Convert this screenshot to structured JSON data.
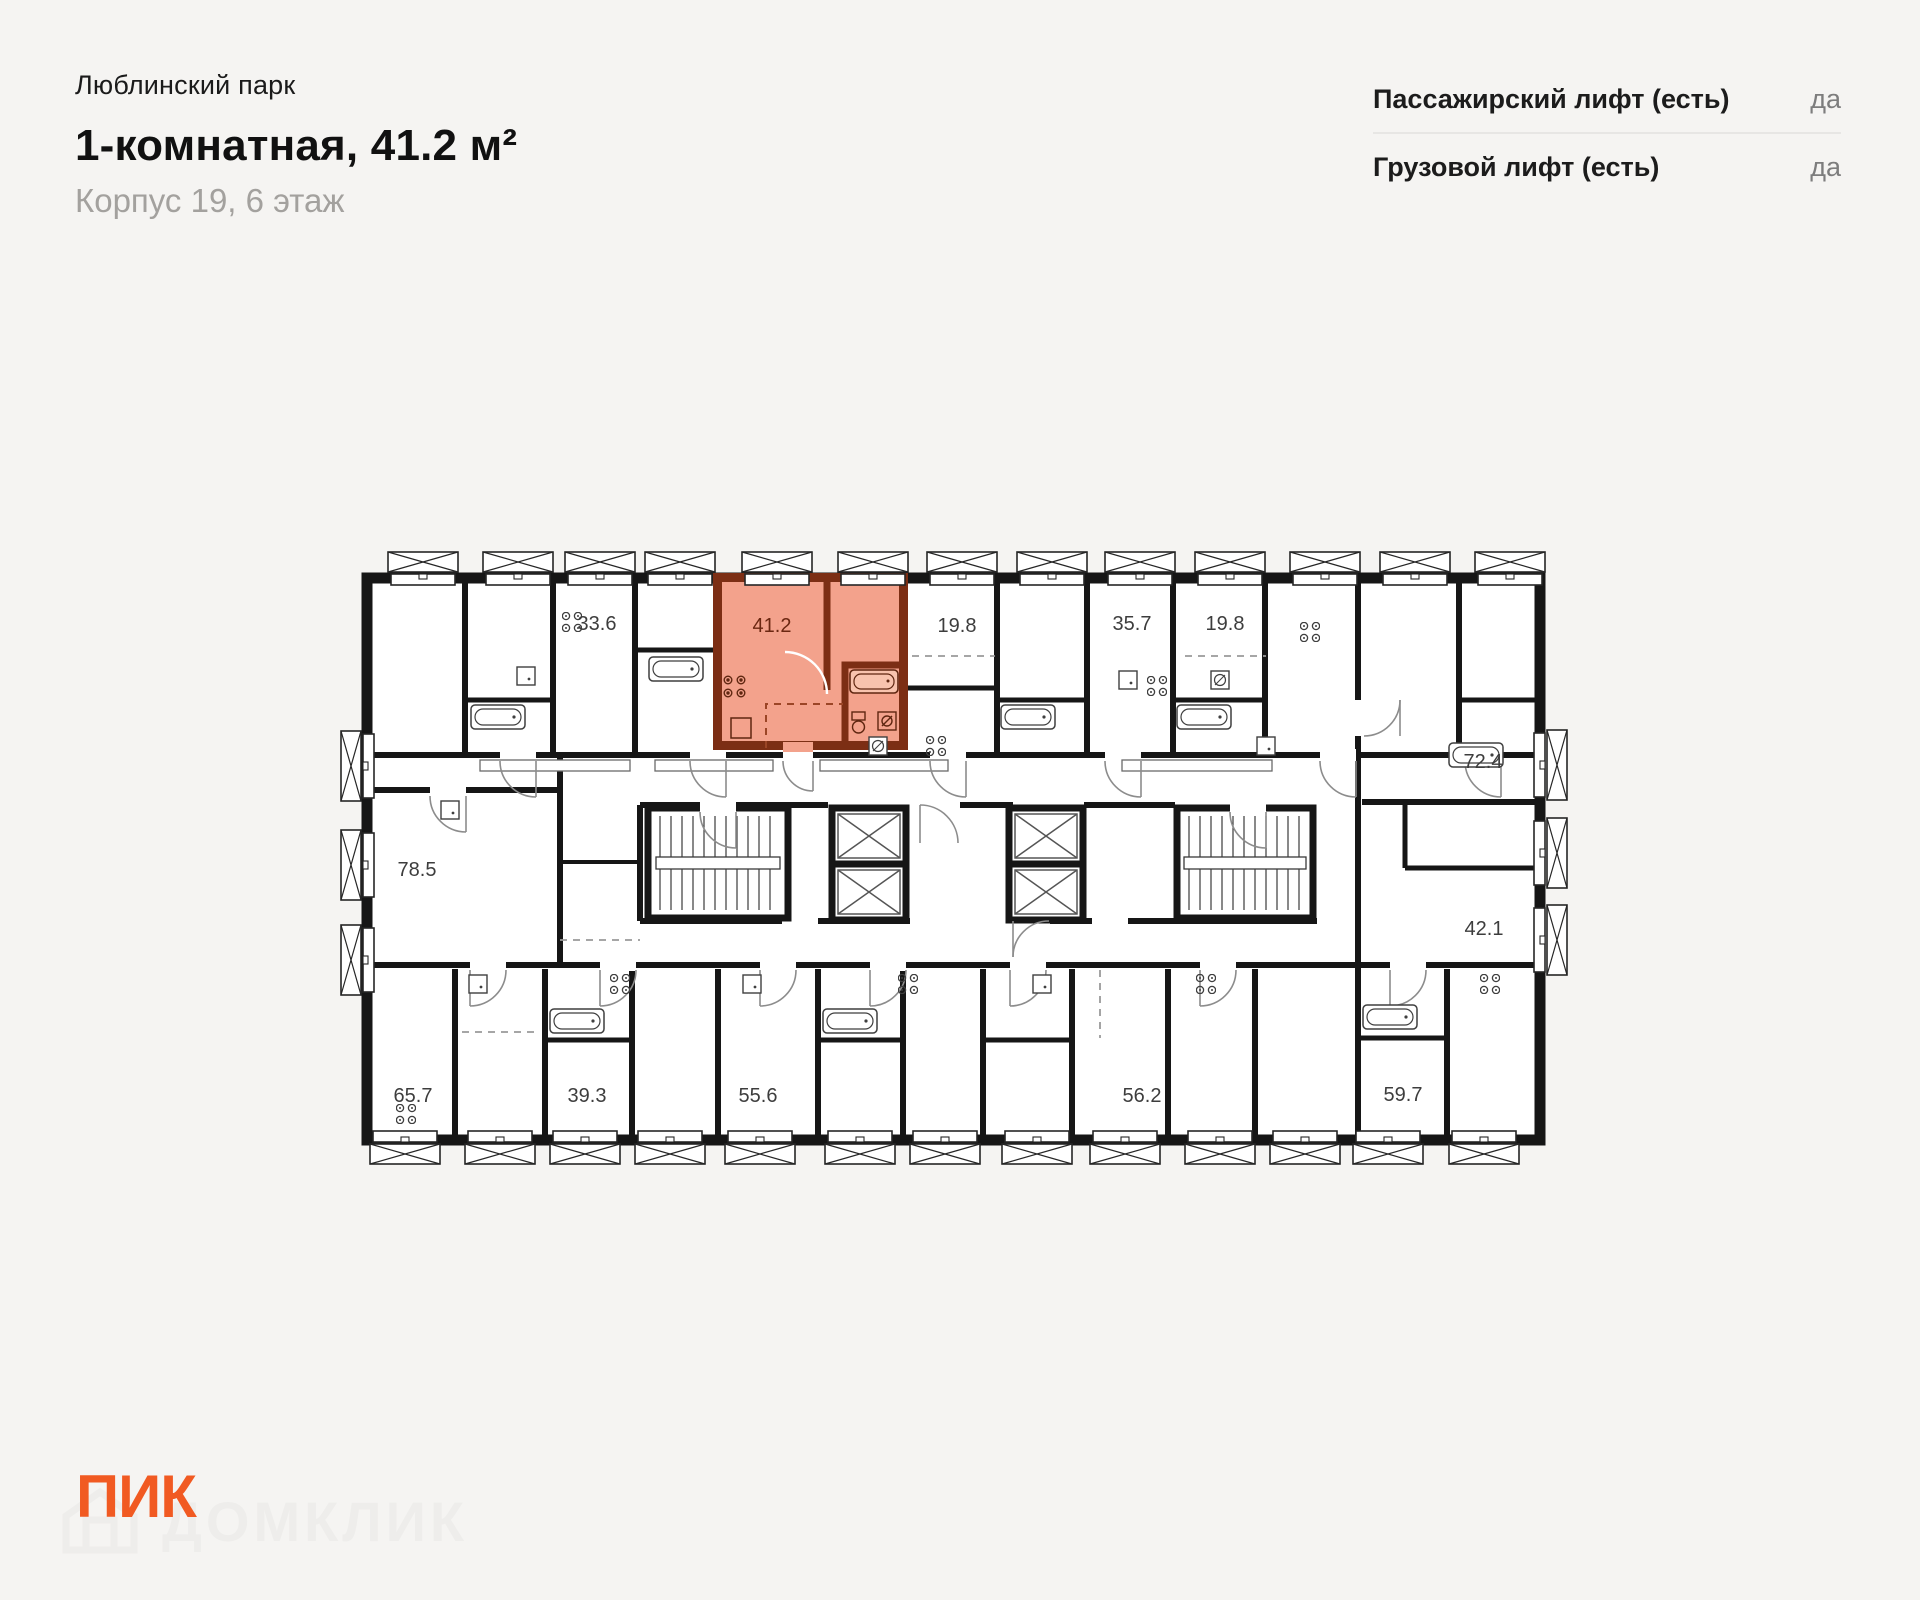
{
  "header": {
    "project": "Люблинский парк",
    "title": "1-комнатная, 41.2 м²",
    "subtitle": "Корпус 19, 6 этаж"
  },
  "lifts": {
    "rows": [
      {
        "label": "Пассажирский лифт (есть)",
        "value": "да"
      },
      {
        "label": "Грузовой лифт (есть)",
        "value": "да"
      }
    ]
  },
  "floorplan": {
    "highlighted_unit": {
      "area": "41.2",
      "rooms": "1-комнатная"
    },
    "units": [
      {
        "area": "33.6",
        "highlighted": false
      },
      {
        "area": "41.2",
        "highlighted": true
      },
      {
        "area": "19.8",
        "highlighted": false
      },
      {
        "area": "35.7",
        "highlighted": false
      },
      {
        "area": "19.8",
        "highlighted": false
      },
      {
        "area": "72.4",
        "highlighted": false
      },
      {
        "area": "78.5",
        "highlighted": false
      },
      {
        "area": "42.1",
        "highlighted": false
      },
      {
        "area": "65.7",
        "highlighted": false
      },
      {
        "area": "39.3",
        "highlighted": false
      },
      {
        "area": "55.6",
        "highlighted": false
      },
      {
        "area": "56.2",
        "highlighted": false
      },
      {
        "area": "59.7",
        "highlighted": false
      }
    ]
  },
  "footer": {
    "logo": "ПИК",
    "watermark": "ДОМКЛИК"
  },
  "colors": {
    "accent": "#F15A22",
    "highlight_fill": "#F3A28C",
    "highlight_wall": "#7C2E14",
    "wall": "#161616",
    "value_gray": "#7D7D7D",
    "subtitle_gray": "#A3A19E",
    "watermark_gray": "#EEEDEB"
  }
}
